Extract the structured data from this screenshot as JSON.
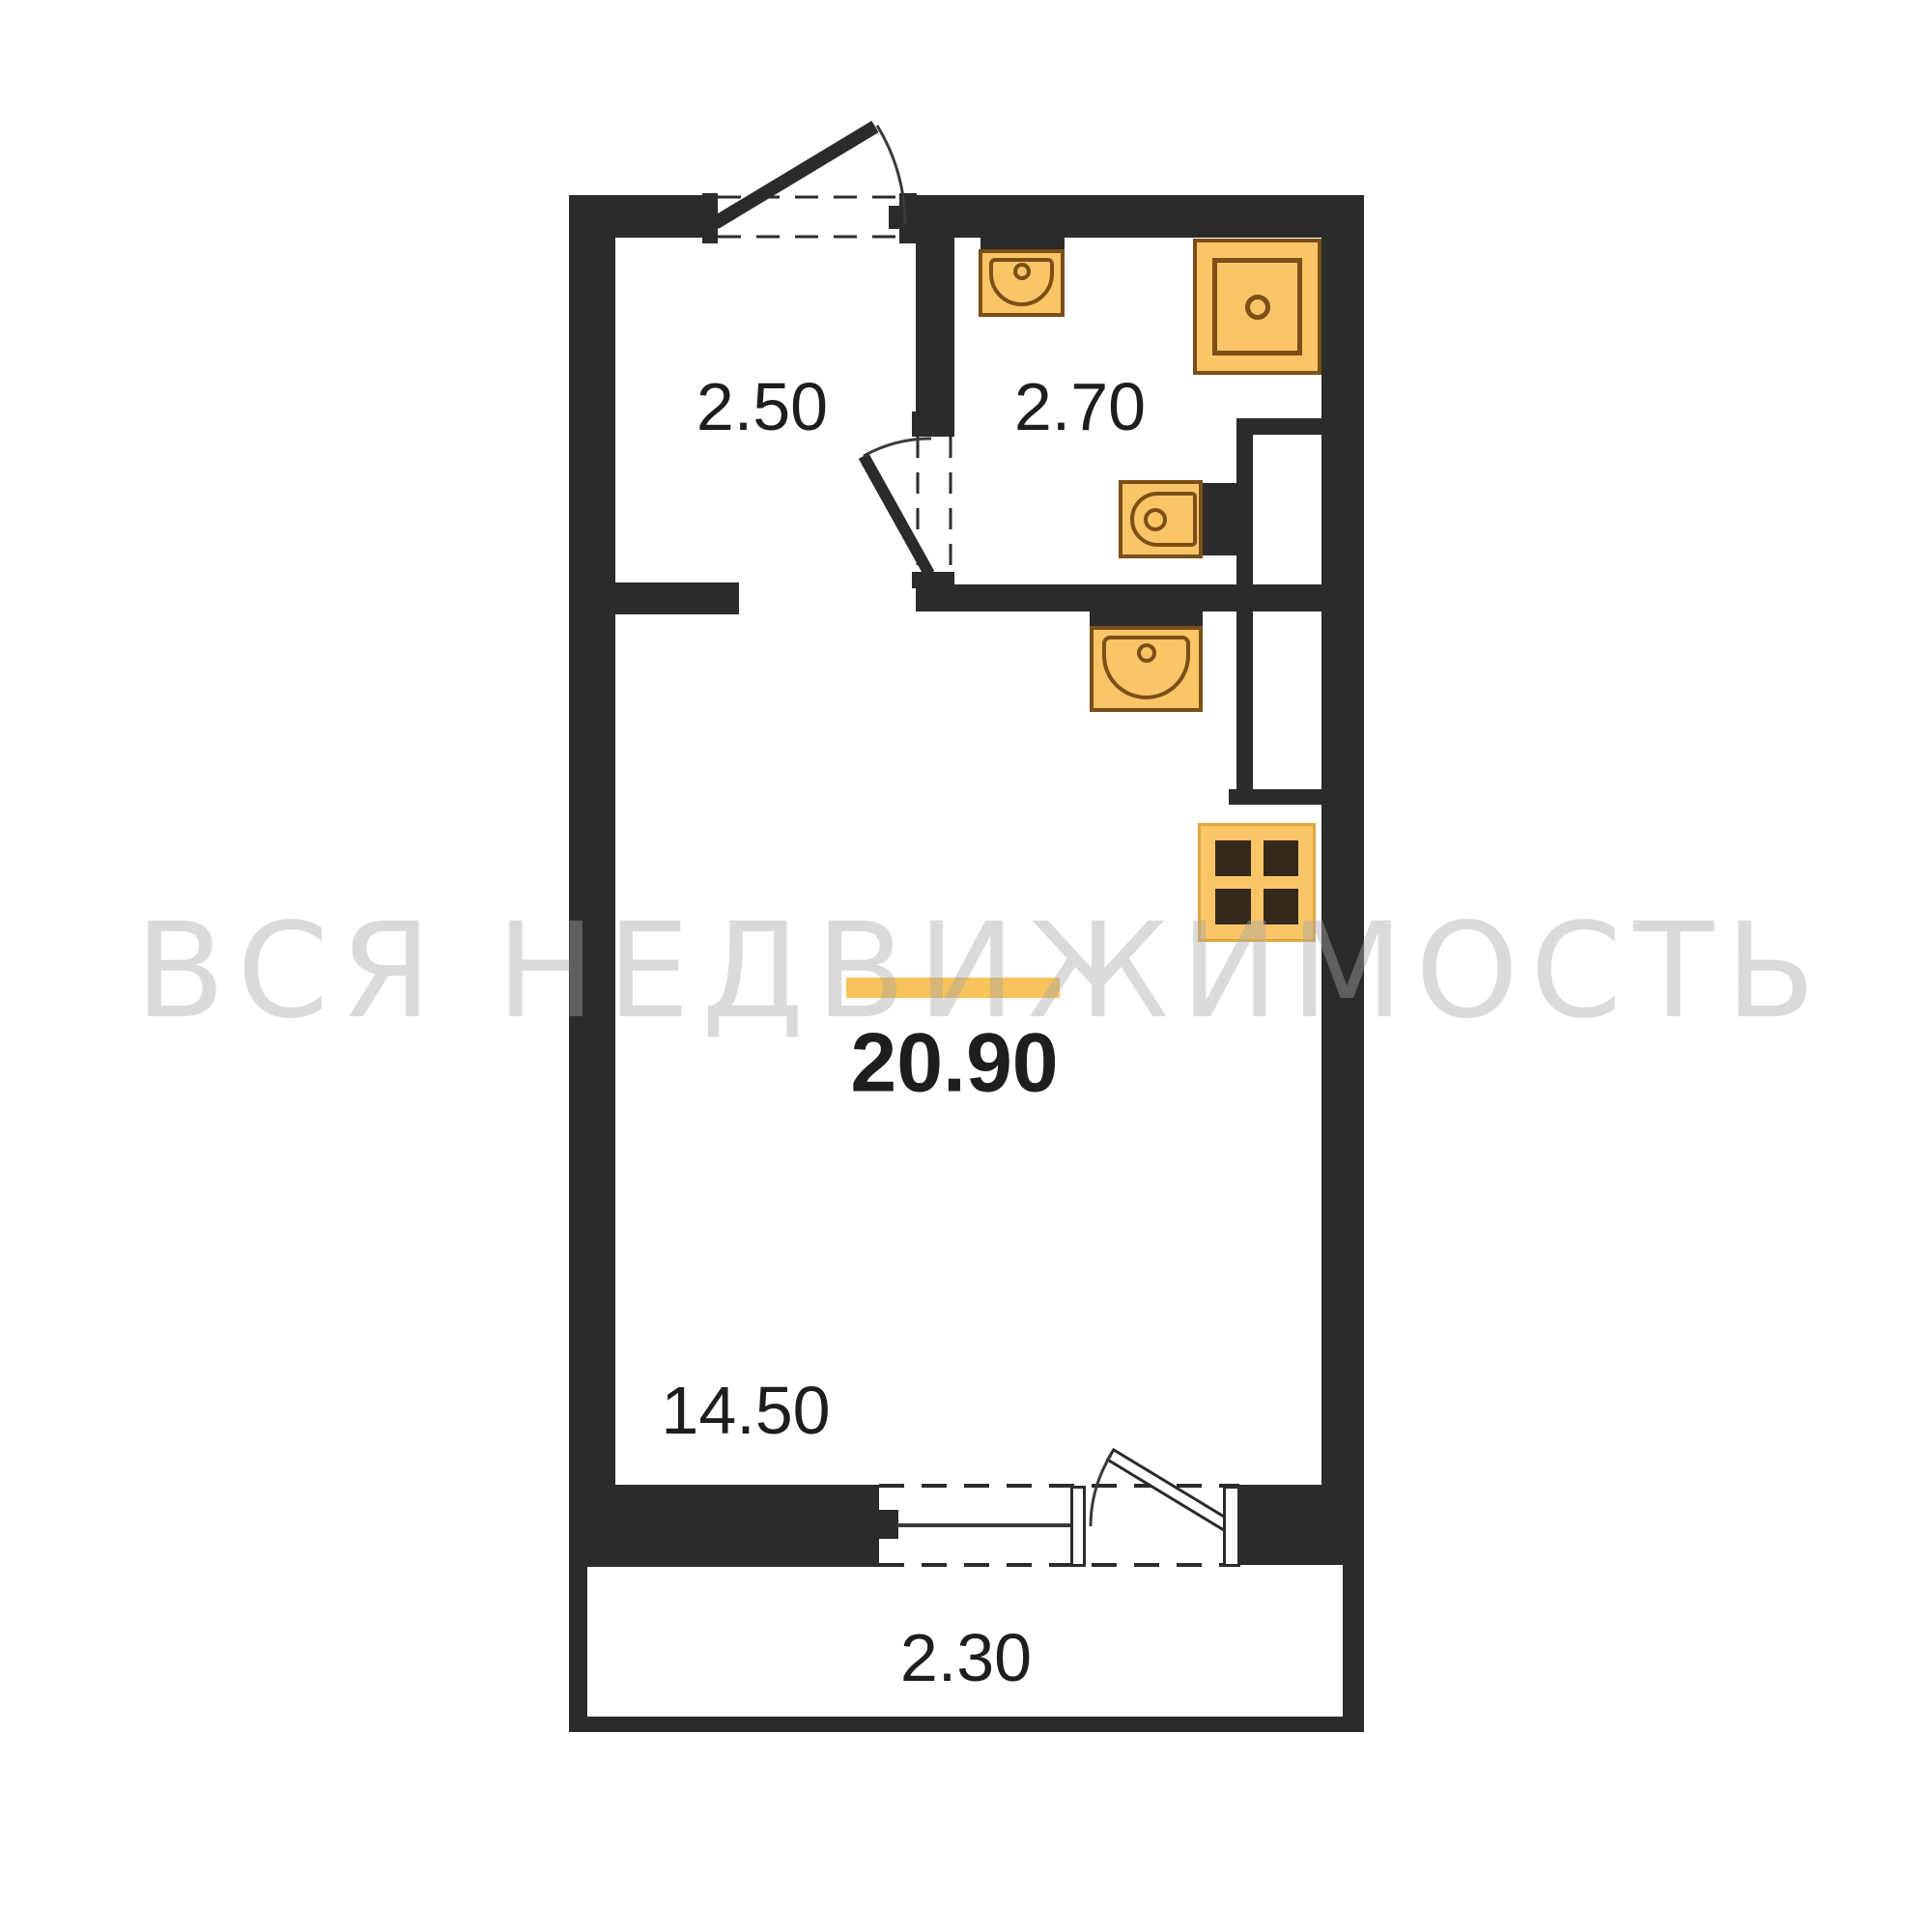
{
  "watermark": "ВСЯ НЕДВИЖИМОСТЬ",
  "areas": {
    "hallway": "2.50",
    "bathroom": "2.70",
    "living_room": "14.50",
    "total": "20.90",
    "balcony": "2.30"
  },
  "fixtures": [
    "bathroom-sink",
    "shower",
    "toilet",
    "kitchen-sink",
    "stove"
  ],
  "colors": {
    "wall": "#2b2b2b",
    "fixture": "#f9c566",
    "fixtureBorder": "#7b4f17",
    "burner": "#34291a",
    "stoveBorder": "#e2a63e",
    "accent": "#f7c35a",
    "ink": "#1e1e1e",
    "wm": "rgba(168,168,168,0.42)"
  }
}
